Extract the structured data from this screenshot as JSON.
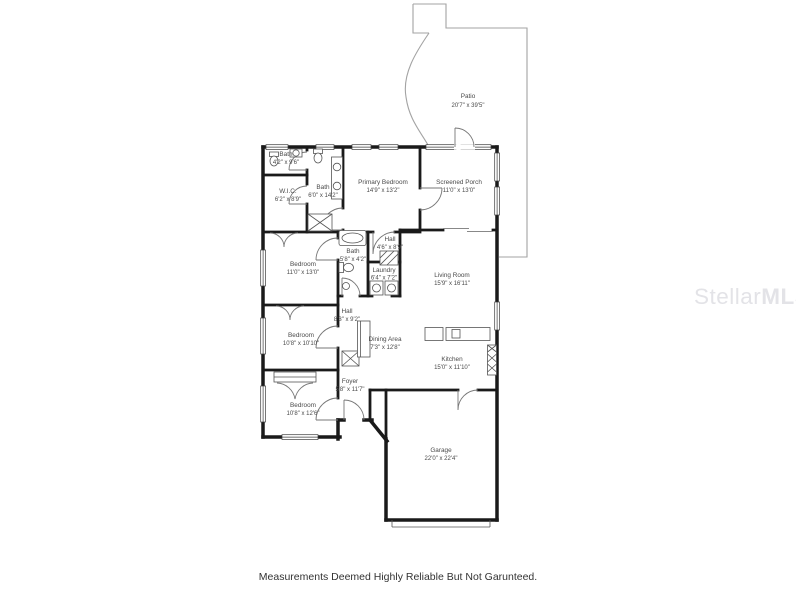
{
  "page": {
    "watermark": {
      "light": "Stellar",
      "bold": "MLS"
    },
    "disclaimer": "Measurements Deemed Highly Reliable But Not Garunteed."
  },
  "colors": {
    "wall": "#1a1a1a",
    "thin_line": "#9b9b9b",
    "label": "#4a4a4a",
    "watermark": "#e3e3e7",
    "background": "#ffffff"
  },
  "rooms": [
    {
      "name": "Patio",
      "dims": "20'7\" x 39'5\""
    },
    {
      "name": "Bath",
      "dims": "4'2\" x 9'6\""
    },
    {
      "name": "W.I.C.",
      "dims": "6'2\" x 8'9\""
    },
    {
      "name": "Bath",
      "dims": "6'0\" x 14'2\""
    },
    {
      "name": "Primary Bedroom",
      "dims": "14'9\" x 13'2\""
    },
    {
      "name": "Screened Porch",
      "dims": "11'0\" x 13'0\""
    },
    {
      "name": "Bedroom",
      "dims": "11'0\" x 13'0\""
    },
    {
      "name": "Bath",
      "dims": "5'8\" x 4'2\""
    },
    {
      "name": "Hall",
      "dims": "4'6\" x 8'9\""
    },
    {
      "name": "Laundry",
      "dims": "6'4\" x 7'2\""
    },
    {
      "name": "Living Room",
      "dims": "15'9\" x 16'11\""
    },
    {
      "name": "Bedroom",
      "dims": "10'8\" x 10'10\""
    },
    {
      "name": "Hall",
      "dims": "8'3\" x 9'2\""
    },
    {
      "name": "Dining Area",
      "dims": "7'3\" x 12'8\""
    },
    {
      "name": "Kitchen",
      "dims": "15'0\" x 11'10\""
    },
    {
      "name": "Foyer",
      "dims": "5'8\" x 11'7\""
    },
    {
      "name": "Bedroom",
      "dims": "10'8\" x 12'6\""
    },
    {
      "name": "Garage",
      "dims": "22'0\" x 22'4\""
    }
  ]
}
